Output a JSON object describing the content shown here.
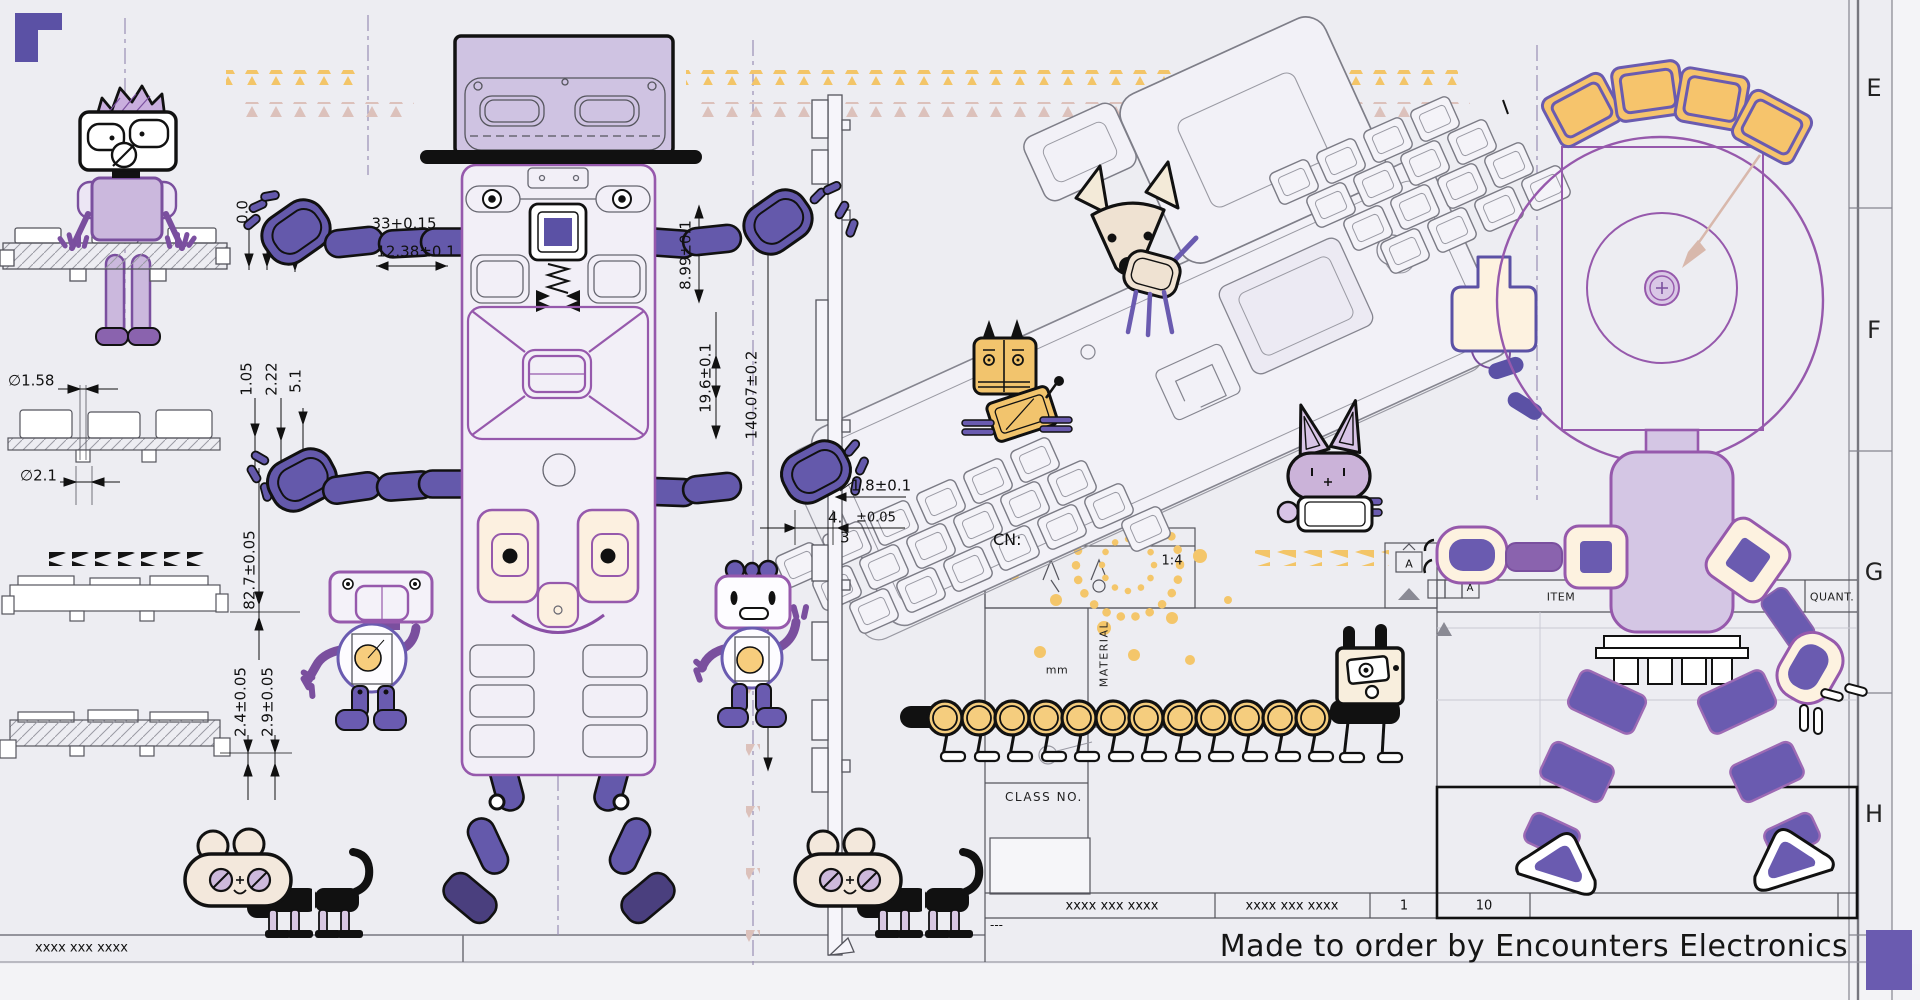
{
  "frame": {
    "zone_letters": [
      "E",
      "F",
      "G",
      "H"
    ],
    "footer_left": "xxxx xxx xxxx"
  },
  "title_block": {
    "cn_label": "CN:",
    "scale": "1:4",
    "units_label": "mm",
    "material_label": "MATERIAL",
    "class_no_label": "CLASS NO.",
    "item_label": "ITEM",
    "quant_label": "QUANT.",
    "detail_label": "A",
    "datum_label": "A",
    "part_number_1": "xxxx xxx xxxx",
    "part_number_2": "xxxx xxx xxxx",
    "sheet_number": "1",
    "quantity": "10",
    "revision_dashes": "---",
    "tagline": "Made to order by Encounters Electronics"
  },
  "dimensions": {
    "zero": "0.0",
    "width_top": "33+0.15",
    "width_top2": "12.38±0.1",
    "height_right": "8.99±0.1",
    "height_mid": "19.6±0.1",
    "height_total": "140.07±0.2",
    "dia_small": "∅1.58",
    "dia_large": "∅2.1",
    "stack_1": "1.05",
    "stack_2": "2.22",
    "stack_3": "5.1",
    "length_side": "82.7±0.05",
    "thick_1": "2.4±0.05",
    "thick_2": "2.9±0.05",
    "pitch": "1.8±0.1",
    "gap_int": "4.",
    "gap_frac": "3",
    "gap_tol": "±0.05"
  },
  "colors": {
    "background": "#ededf2",
    "purple": "#6459ab",
    "purple_dark": "#4a3f7e",
    "violet_line": "#9659ac",
    "lavender": "#cfc3e0",
    "cream": "#fdf2e0",
    "amber": "#f3c568",
    "pink": "#dcc1bb",
    "ink": "#111111"
  }
}
